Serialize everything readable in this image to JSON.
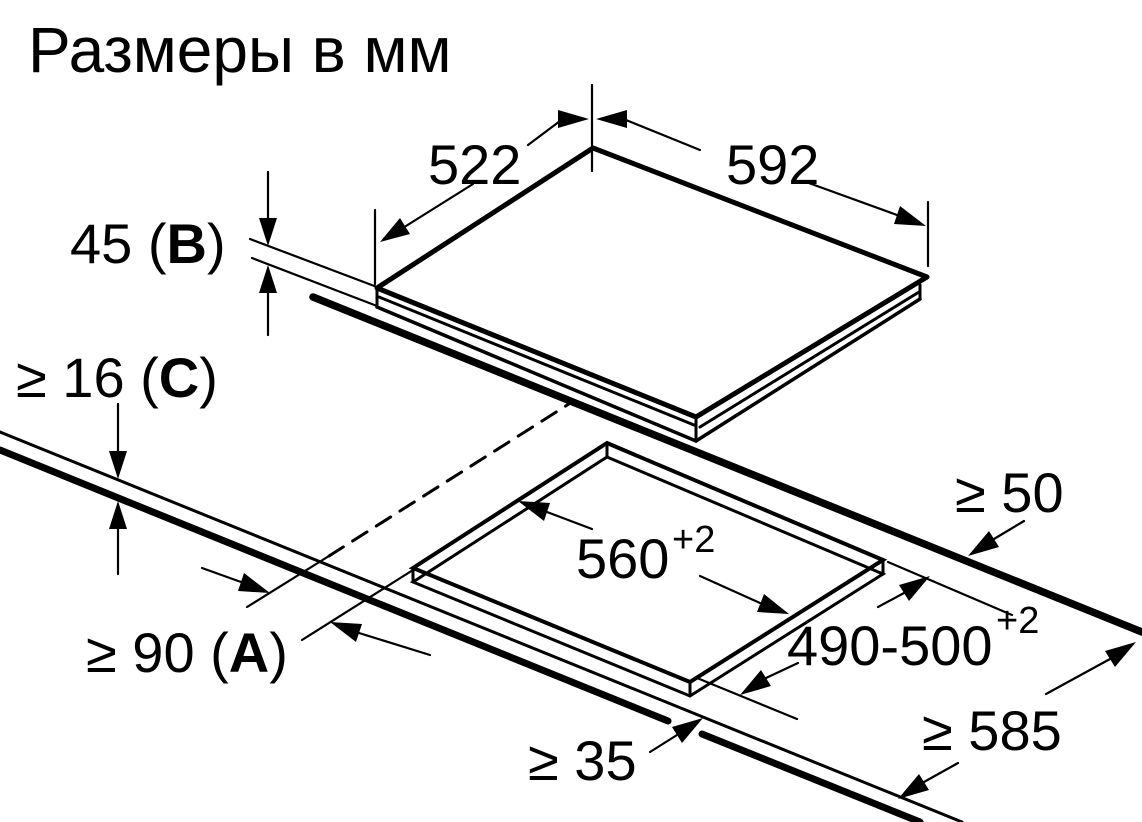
{
  "title": "Размеры в мм",
  "drawing": {
    "kind": "cooktop-installation-dimensions",
    "unit": "мм"
  },
  "dimensions": {
    "cooktop_depth": "522",
    "cooktop_width": "592",
    "cooktop_height": {
      "pre": "45 (",
      "ref": "B",
      "post": ")"
    },
    "worktop_thickness": {
      "pre": "≥ 16 (",
      "ref": "C",
      "post": ")"
    },
    "cutout_width": {
      "value": "560",
      "tolerance": "+2"
    },
    "cutout_depth": {
      "value": "490-500",
      "tolerance": "+2"
    },
    "rear_clearance": "≥ 50",
    "front_clearance": {
      "pre": "≥ 90 (",
      "ref": "A",
      "post": ")"
    },
    "front_edge_min": "≥ 35",
    "worktop_depth_min": "≥ 585"
  },
  "colors": {
    "line": "#000000",
    "background": "#ffffff"
  }
}
